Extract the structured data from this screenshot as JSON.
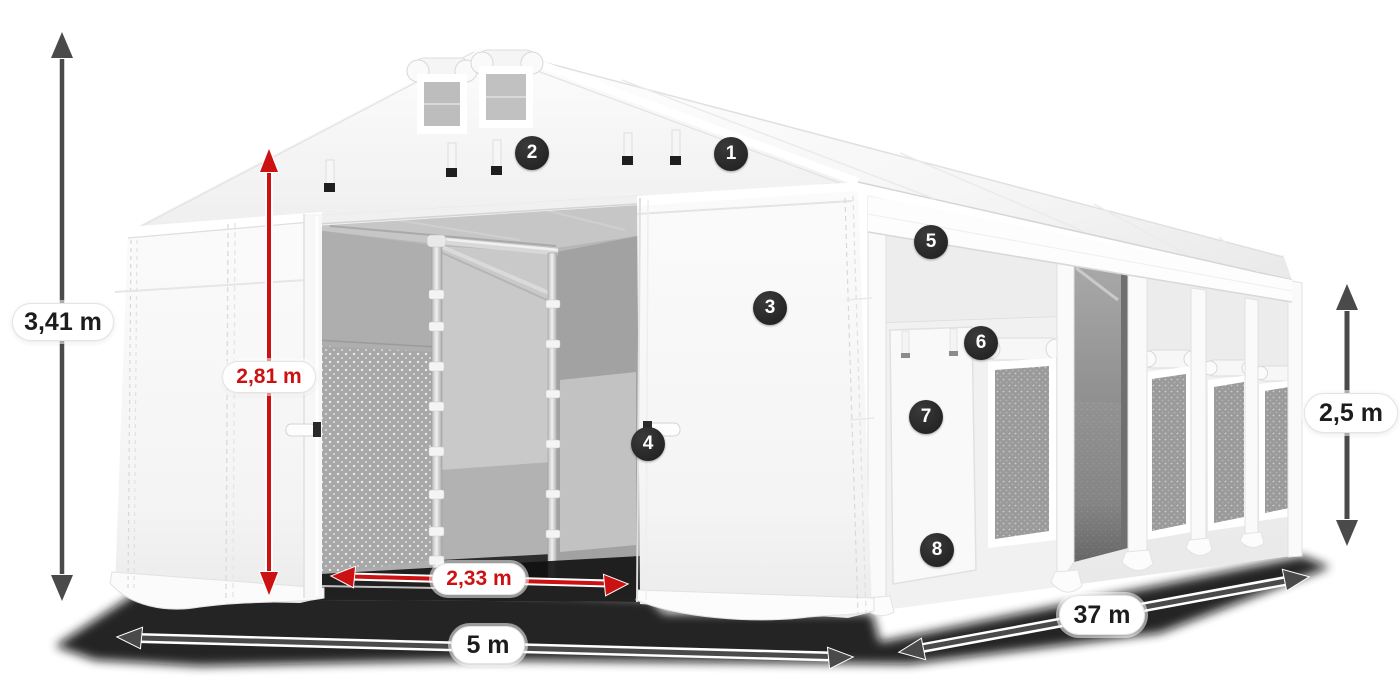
{
  "badges": [
    {
      "label": "1"
    },
    {
      "label": "2"
    },
    {
      "label": "3"
    },
    {
      "label": "4"
    },
    {
      "label": "5"
    },
    {
      "label": "6"
    },
    {
      "label": "7"
    },
    {
      "label": "8"
    }
  ],
  "dimensions": {
    "total_height": "3,41 m",
    "door_height": "2,81 m",
    "door_width": "2,33 m",
    "front_width": "5 m",
    "length": "37 m",
    "side_height": "2,5 m"
  },
  "colors": {
    "red": "#cc1112",
    "arrow-gray": "#4a4a4a",
    "badge-bg": "#262626",
    "pill-border": "#e4e4e4"
  }
}
